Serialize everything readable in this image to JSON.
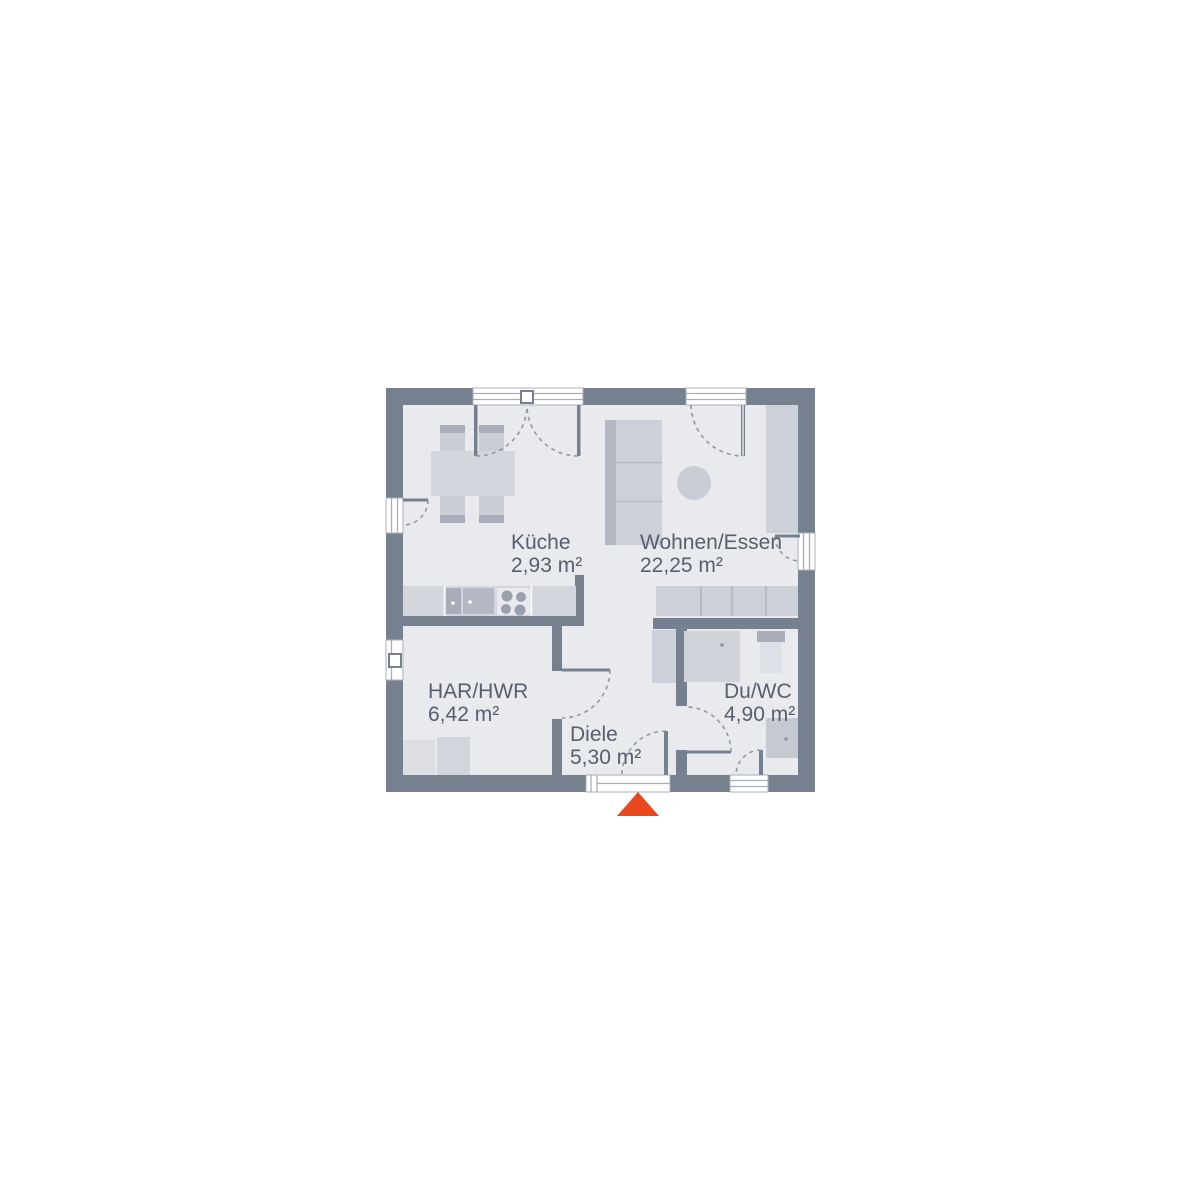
{
  "rooms": [
    {
      "name": "Küche",
      "area": "2,93 m²"
    },
    {
      "name": "Wohnen/Essen",
      "area": "22,25 m²"
    },
    {
      "name": "HAR/HWR",
      "area": "6,42 m²"
    },
    {
      "name": "Diele",
      "area": "5,30 m²"
    },
    {
      "name": "Du/WC",
      "area": "4,90 m²"
    }
  ],
  "colors": {
    "wall": "#76808E",
    "floor": "#E9EAEE",
    "furniture_light": "#D3D6DD",
    "furniture_mid": "#C9CDD6",
    "accent_dark": "#A9AEBA",
    "label_text": "#575F6E",
    "entrance_marker": "#E8481B"
  }
}
